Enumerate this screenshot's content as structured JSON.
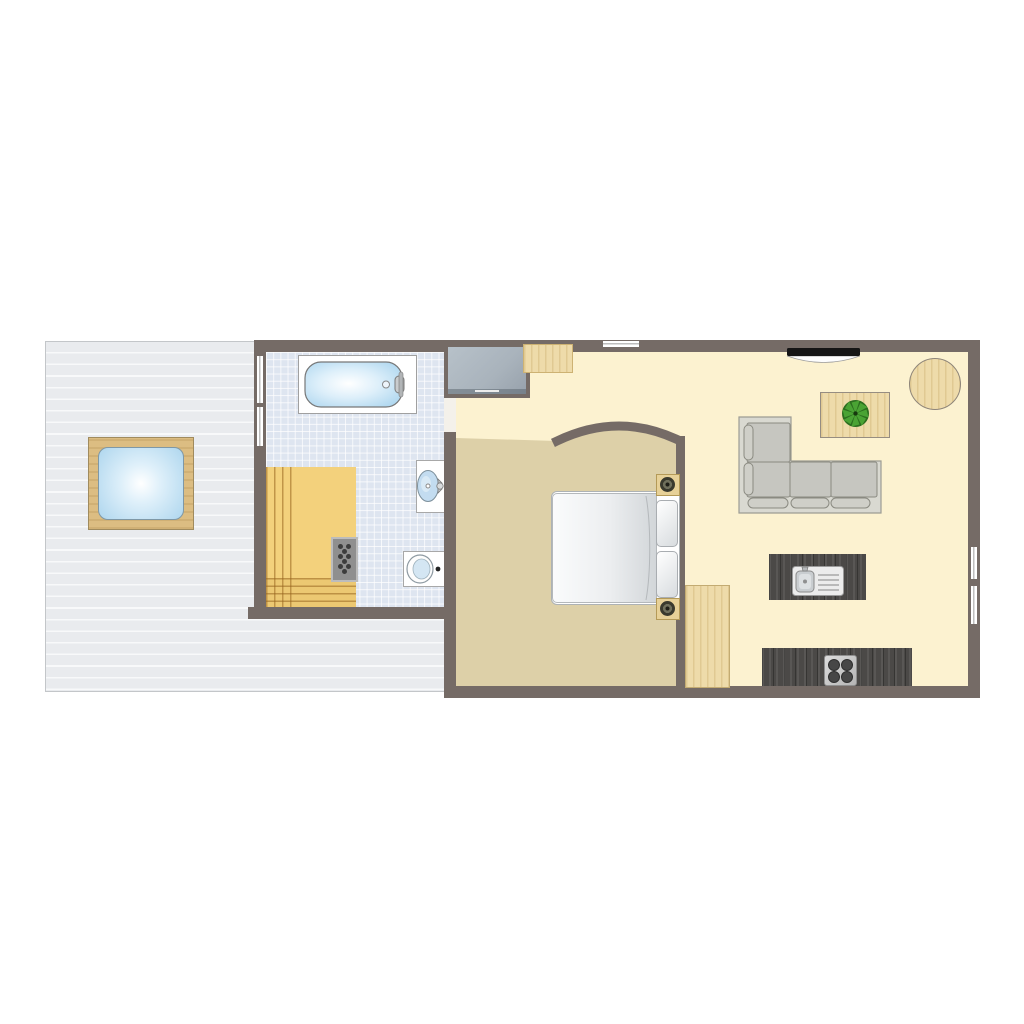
{
  "page": {
    "title": "apartment-floor-plan",
    "background": "#ffffff"
  },
  "colors": {
    "wall": "#756b66",
    "living-floor": "#fcf2d0",
    "bedroom-floor": "#ddd0a8",
    "tile": "#dee5f0",
    "deck": "#e9ebee",
    "deck-stripe": "#f8f9fa",
    "sauna-wood": "#f3d17c",
    "wood-light": "#eedbaa",
    "kitchen-dark": "#4b4947",
    "sofa-base": "#d9d9d1",
    "sofa-cushion": "#c6c6c0",
    "wardrobe": "#a9b3bc",
    "water": "#aed6ee",
    "tv": "#151515",
    "plant": "#449a2e",
    "window": "#ffffff"
  },
  "plan": {
    "type": "floor-plan",
    "rooms": [
      {
        "id": "terrace-deck",
        "floor": "wood planks",
        "furniture": [
          "hot-tub"
        ]
      },
      {
        "id": "bathroom",
        "floor": "blue tile",
        "furniture": [
          "bathtub",
          "wall-sink",
          "toilet",
          "sauna-bench",
          "sauna-heater"
        ]
      },
      {
        "id": "hallway",
        "floor": "cream",
        "furniture": [
          "wardrobe",
          "wall-shelf"
        ]
      },
      {
        "id": "bedroom",
        "floor": "tan",
        "furniture": [
          "double-bed",
          "pillow",
          "pillow",
          "nightstand-lamp",
          "nightstand-lamp",
          "cabinet"
        ],
        "feature": "curved arch wall"
      },
      {
        "id": "living-kitchen",
        "floor": "cream",
        "furniture": [
          "wall-tv",
          "l-shaped-sofa",
          "coffee-table",
          "potted-plant",
          "round-table",
          "kitchen-island-sink",
          "cooktop-counter"
        ]
      }
    ],
    "windows": [
      {
        "wall": "bathroom-left",
        "count": 2
      },
      {
        "wall": "top",
        "count": 1
      },
      {
        "wall": "right",
        "count": 2
      }
    ],
    "doors": [
      {
        "between": "bathroom-hallway",
        "type": "opening"
      },
      {
        "between": "hallway-bedroom",
        "type": "open passage under arch"
      }
    ]
  }
}
